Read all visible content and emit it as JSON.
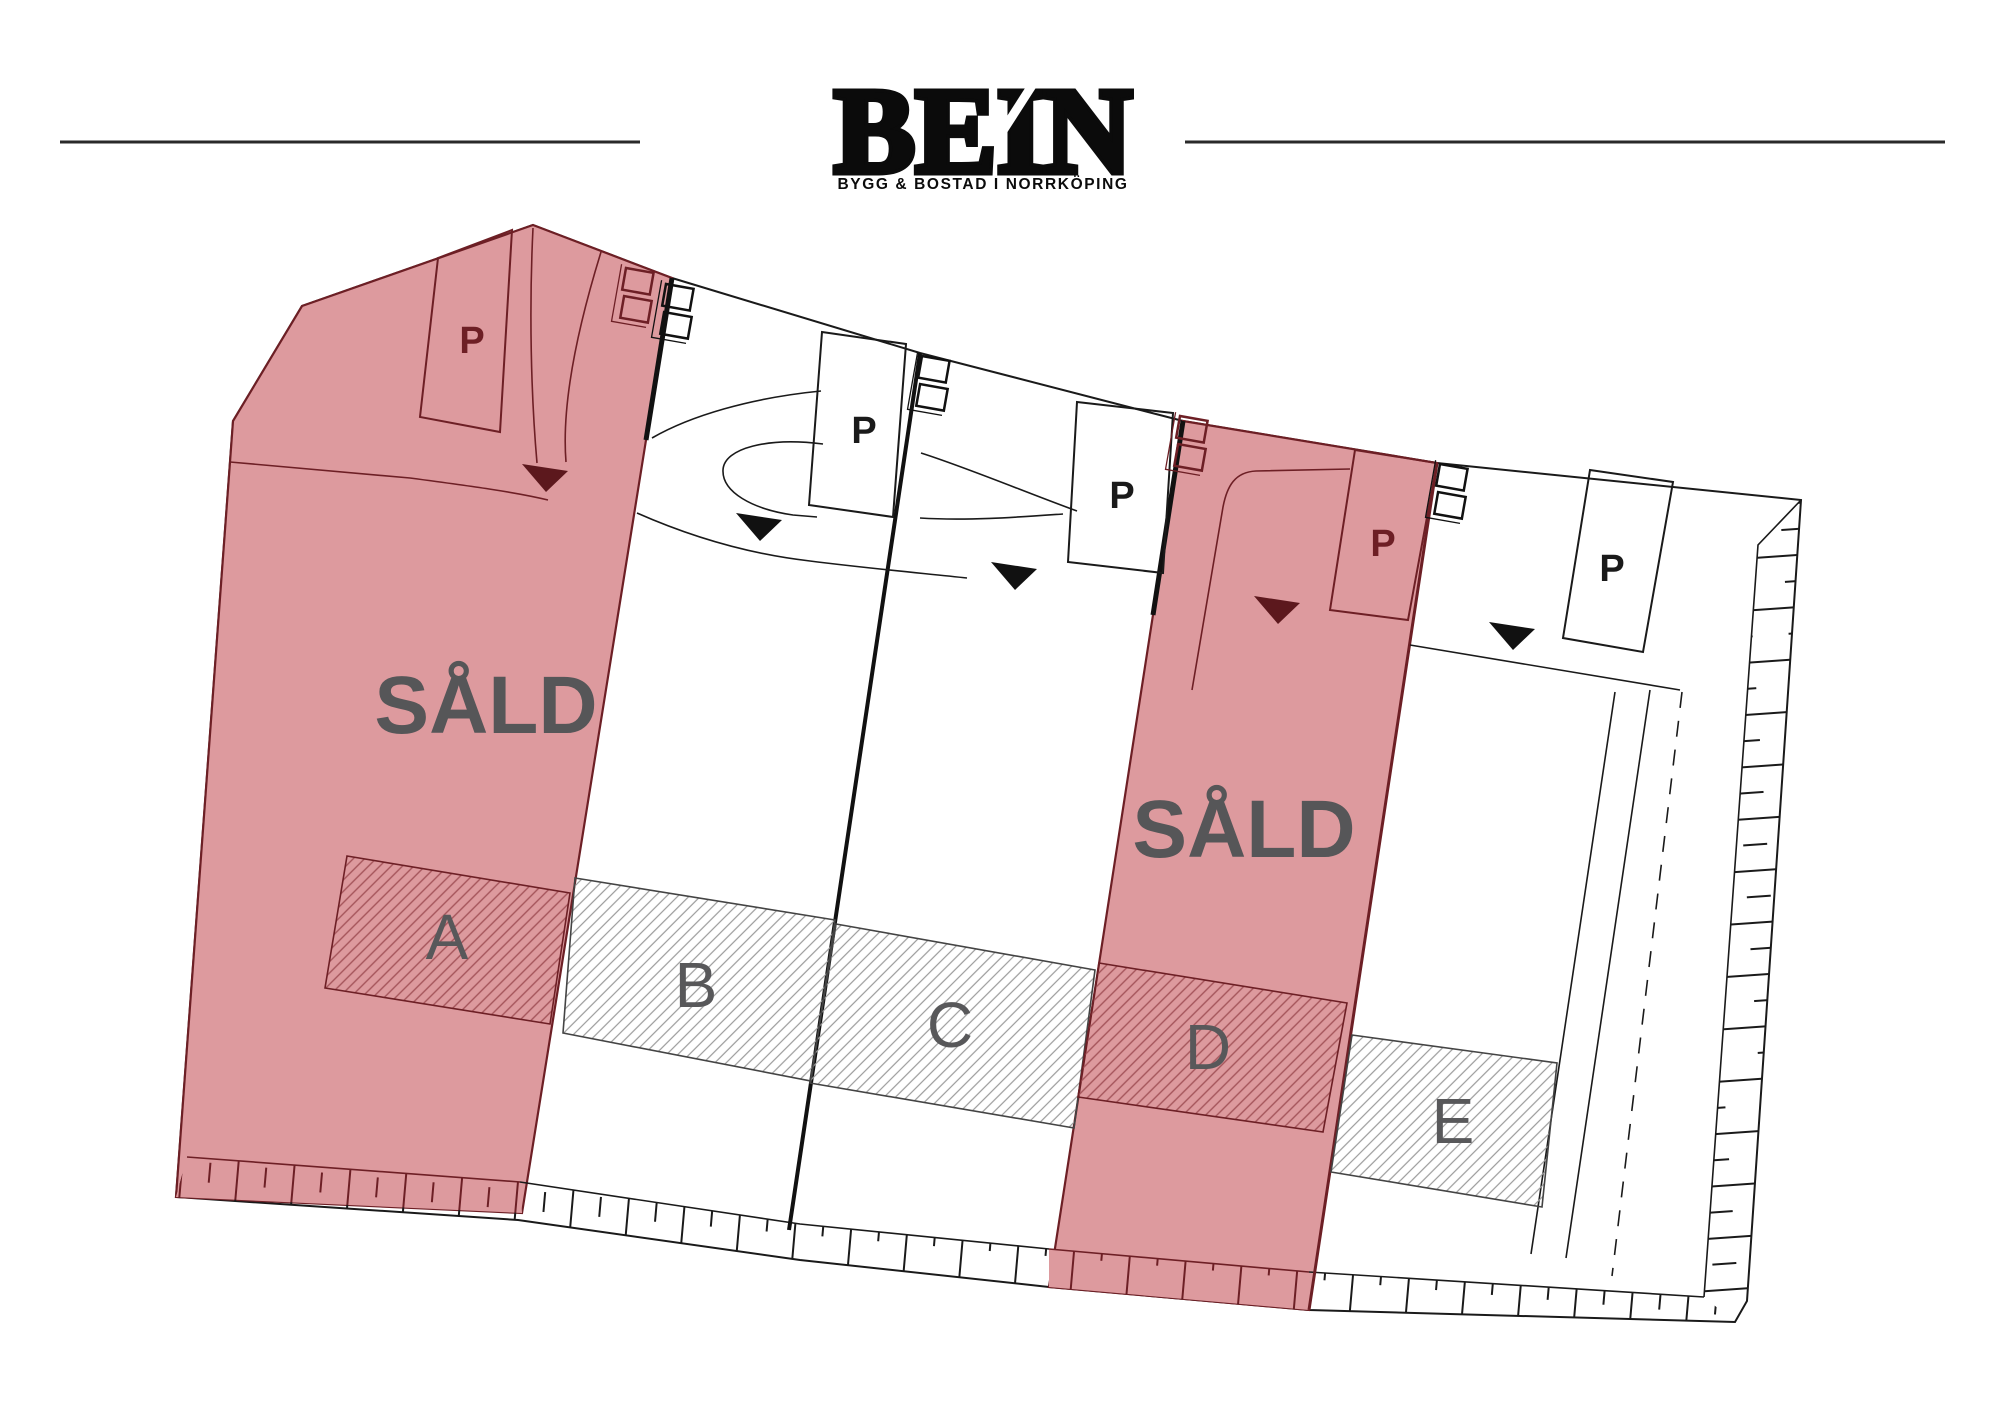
{
  "brand": {
    "logo": "BEIN",
    "tagline": "BYGG & BOSTAD I NORRKÖPING"
  },
  "plan": {
    "sold_label": "SÅLD",
    "parking_label": "P",
    "plots": [
      {
        "id": "A",
        "label": "A",
        "status": "sold"
      },
      {
        "id": "B",
        "label": "B",
        "status": "available"
      },
      {
        "id": "C",
        "label": "C",
        "status": "available"
      },
      {
        "id": "D",
        "label": "D",
        "status": "sold"
      },
      {
        "id": "E",
        "label": "E",
        "status": "available"
      }
    ],
    "colors": {
      "sold_fill": "#DD9A9E",
      "sold_border": "#6D1F25",
      "sold_hatch": "#A4545A",
      "sold_text": "#565658",
      "plot_label": "#58585a",
      "line": "#1a1a1a",
      "hatch": "#9b9b9b"
    }
  }
}
